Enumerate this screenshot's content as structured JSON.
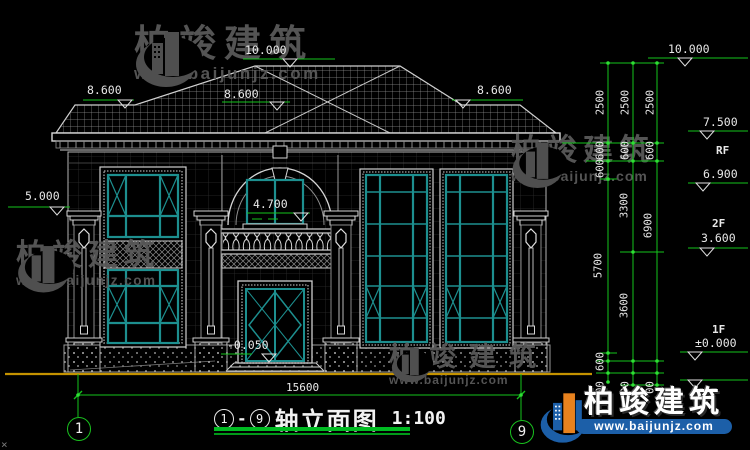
{
  "drawing": {
    "title": {
      "axis_start": "1",
      "separator": "-",
      "axis_end": "9",
      "name": "轴立面图",
      "scale": "1:100"
    },
    "axis_bubbles": {
      "left": "1",
      "right": "9"
    },
    "elevation_labels": {
      "ridge": "10.000",
      "eave_left": "8.600",
      "eave_mid": "8.600",
      "eave_right": "8.600",
      "pillar": "5.000",
      "balcony": "4.700",
      "entrance": "-0.050"
    },
    "right_labels": {
      "ridge": "10.000",
      "parapet": "7.500",
      "rf": "RF",
      "roof_low": "6.900",
      "f2": "2F",
      "f2_level": "3.600",
      "f1": "1F",
      "f1_level": "±0.000"
    },
    "chains": {
      "col1": [
        "2500",
        "600",
        "600",
        "5700",
        "600",
        "00"
      ],
      "col2": [
        "2500",
        "600",
        "3300",
        "3600",
        "00"
      ],
      "col3": [
        "2500",
        "600",
        "6900",
        "00"
      ]
    },
    "width_dim": "15600",
    "stray_mark": "×"
  },
  "watermark": {
    "brand": "柏竣建筑",
    "site": "www.baijunjz.com"
  },
  "logo": {
    "brand": "柏竣建筑",
    "site": "www.baijunjz.com"
  },
  "colors": {
    "dim_green": "#15c41c",
    "ground_orange": "#c49200",
    "window_teal": "#1d8f8f",
    "logo_blue": "#1c5fa8",
    "logo_orange": "#e8821e",
    "watermark_gray": "#585858"
  }
}
